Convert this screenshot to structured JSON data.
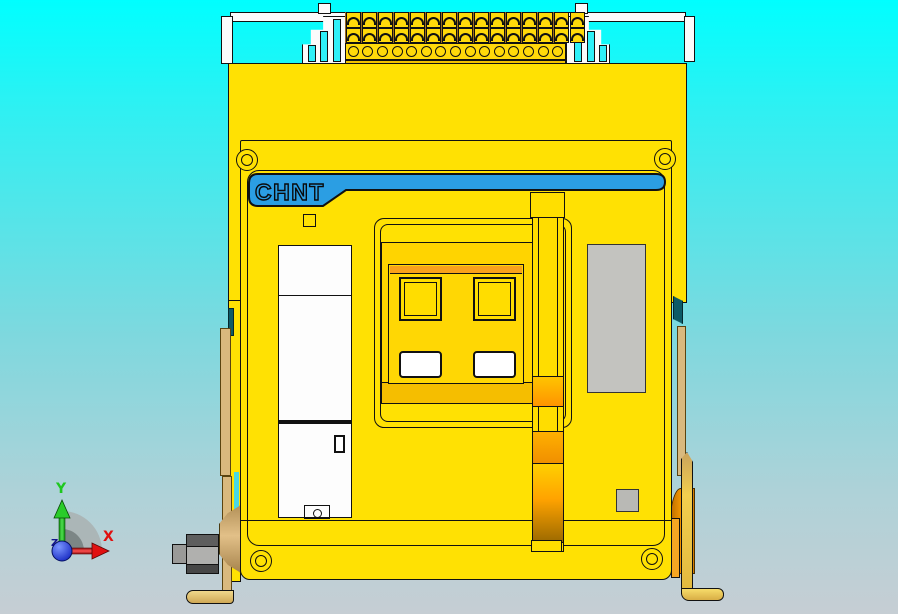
{
  "scene": {
    "background_top": "#00ffff",
    "background_bottom": "#c6ced4"
  },
  "model": {
    "name": "chint-air-circuit-breaker-front",
    "brand_label": "CHNT",
    "colors": {
      "body_yellow": "#ffe103",
      "panel_gold": "#ffd400",
      "accent_orange": "#f9a11b",
      "brand_blue": "#2b9ee3",
      "label_gray": "#c3c3bf",
      "hardware_gray": "#b0b0ae",
      "bracket_tan": "#d9b97e",
      "outline": "#111111"
    },
    "terminal_strip": {
      "columns": 15,
      "screw_rows": 2,
      "circle_count": 15
    }
  },
  "axis_triad": {
    "x_label": "X",
    "y_label": "Y",
    "z_label": "Z",
    "x_color": "#e01010",
    "y_color": "#1ec81e",
    "z_color": "#14148c"
  }
}
